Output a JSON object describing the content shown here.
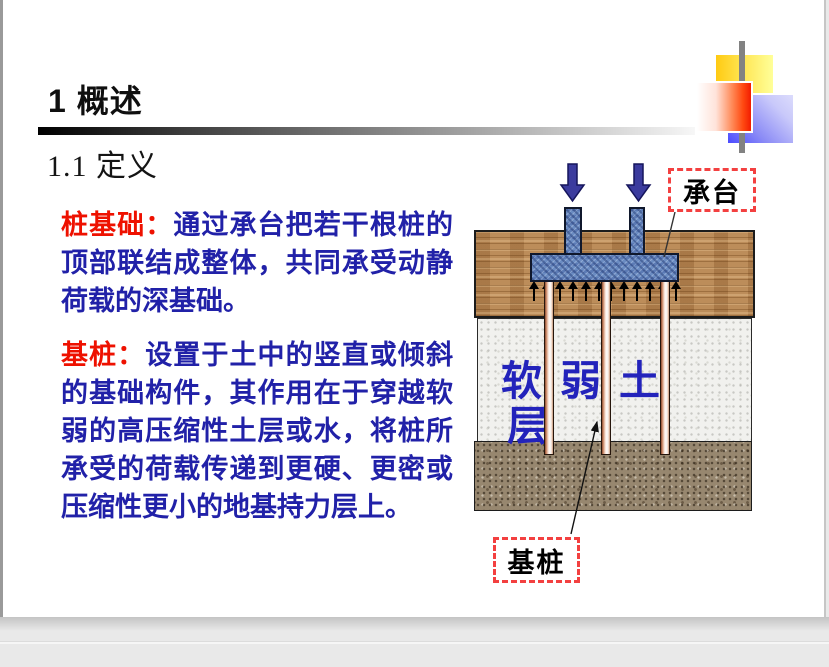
{
  "slide": {
    "title": "1 概述",
    "subtitle": "1.1 定义",
    "definitions": [
      {
        "term": "桩基础：",
        "text": "通过承台把若干根桩的顶部联结成整体，共同承受动静荷载的深基础。"
      },
      {
        "term": "基桩：",
        "text": "设置于土中的竖直或倾斜的基础构件，其作用在于穿越软弱的高压缩性土层或水，将桩所承受的荷载传递到更硬、更密或压缩性更小的地基持力层上。"
      }
    ]
  },
  "diagram": {
    "cap_callout": "承台",
    "pile_callout": "基桩",
    "soft_soil_line1": "软弱土",
    "soft_soil_line2": "层"
  },
  "colors": {
    "term_red": "#ee1100",
    "body_blue": "#2121a8",
    "soil_blue": "#2323bb",
    "callout_red": "#f34040",
    "load_arrow_navy": "#3b3b9e",
    "load_arrow_outline": "#15155c"
  }
}
